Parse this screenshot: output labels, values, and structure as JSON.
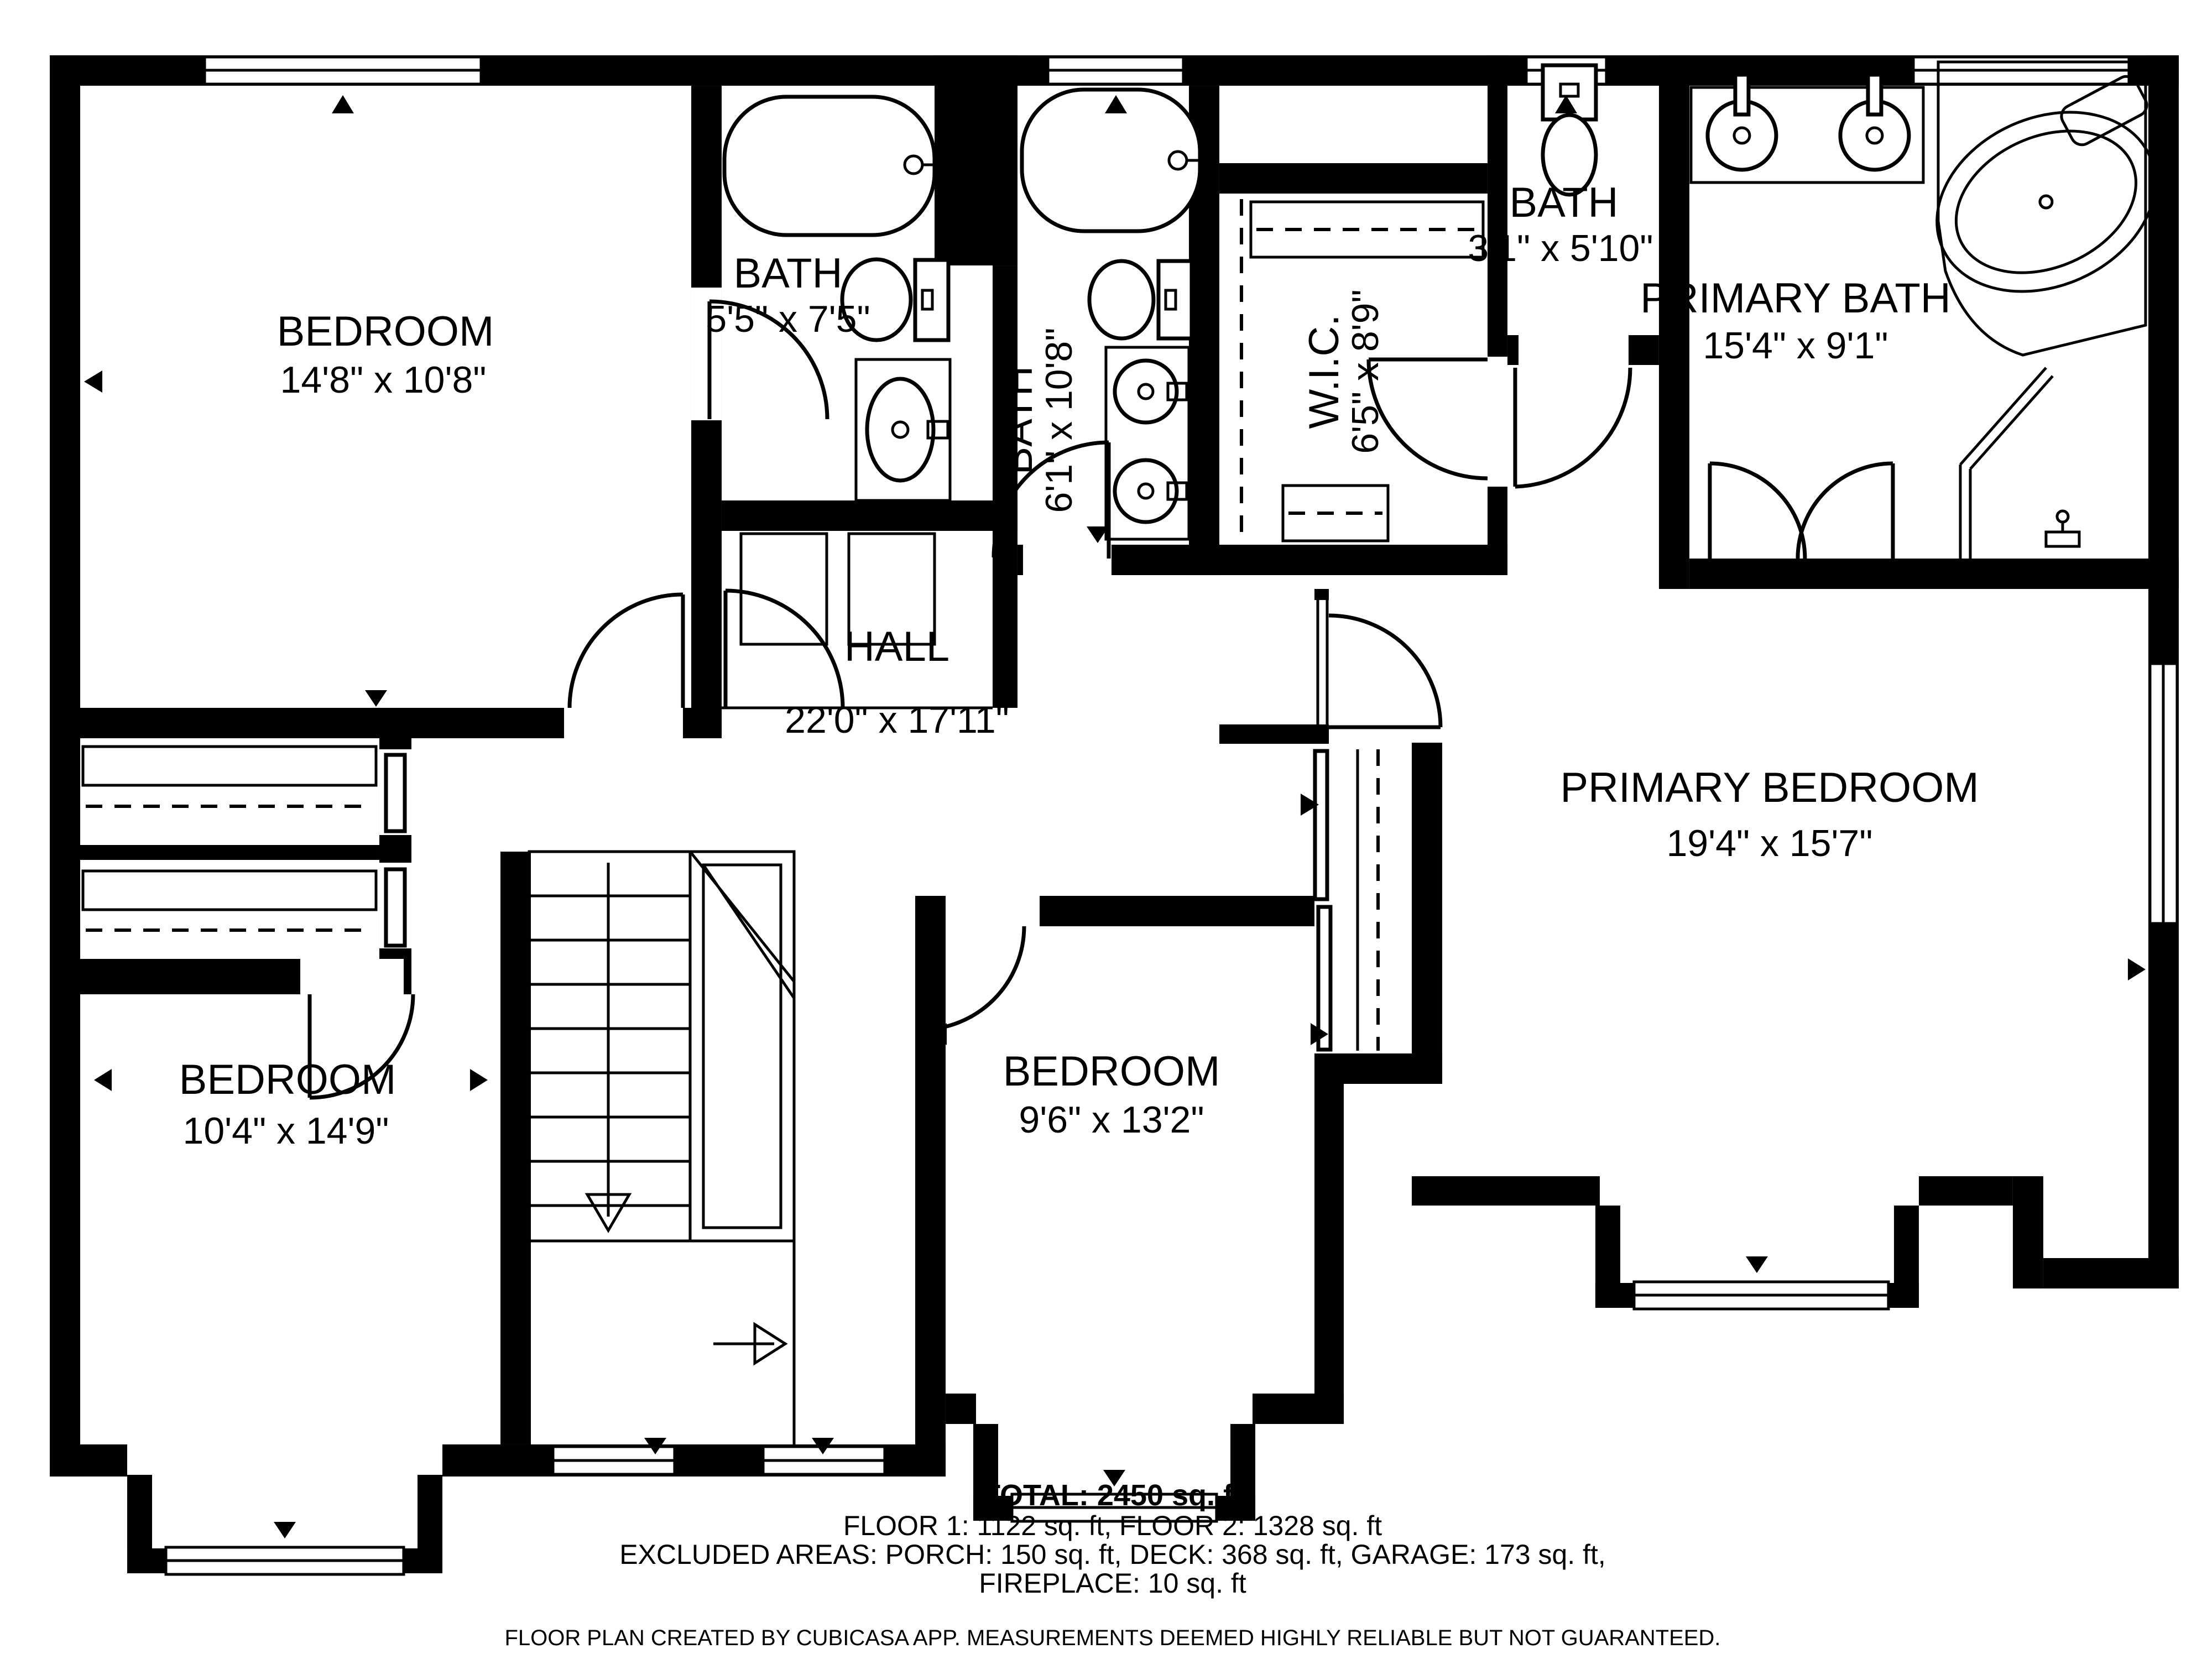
{
  "rooms": [
    {
      "name": "BEDROOM",
      "dims": "14'8\" x 10'8\""
    },
    {
      "name": "BATH",
      "dims": "5'5\" x 7'5\""
    },
    {
      "name": "BATH",
      "dims": "6'1\" x 10'8\""
    },
    {
      "name": "W.I.C.",
      "dims": "6'5\" x 8'9\""
    },
    {
      "name": "BATH",
      "dims": "3'1\" x 5'10\""
    },
    {
      "name": "PRIMARY BATH",
      "dims": "15'4\" x 9'1\""
    },
    {
      "name": "HALL",
      "dims": "22'0\" x 17'11\""
    },
    {
      "name": "PRIMARY BEDROOM",
      "dims": "19'4\" x 15'7\""
    },
    {
      "name": "BEDROOM",
      "dims": "10'4\" x 14'9\""
    },
    {
      "name": "BEDROOM",
      "dims": "9'6\" x 13'2\""
    }
  ],
  "footer": {
    "total": "TOTAL: 2450 sq. ft",
    "floors": "FLOOR 1: 1122 sq. ft, FLOOR 2: 1328 sq. ft",
    "excluded": "EXCLUDED AREAS: PORCH: 150 sq. ft, DECK: 368 sq. ft, GARAGE: 173 sq. ft,",
    "excluded2": "FIREPLACE: 10 sq. ft",
    "disclaimer": "FLOOR PLAN CREATED BY CUBICASA APP. MEASUREMENTS DEEMED HIGHLY RELIABLE BUT NOT GUARANTEED."
  },
  "colors": {
    "wall": "#000000",
    "background": "#ffffff"
  }
}
